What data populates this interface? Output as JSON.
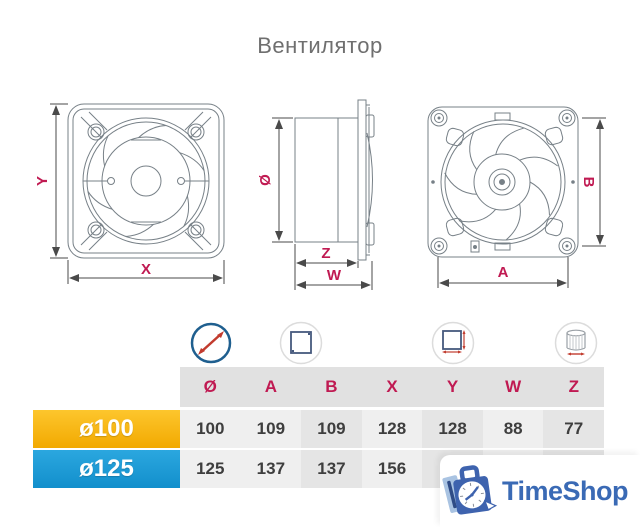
{
  "title": "Вентилятор",
  "diagrams": {
    "front_view": {
      "vertical_label": "Y",
      "horizontal_label": "X"
    },
    "side_view": {
      "diameter_label": "Ø",
      "inner_depth_label": "Z",
      "outer_depth_label": "W"
    },
    "back_view": {
      "vertical_label": "B",
      "horizontal_label": "A"
    }
  },
  "spec_table": {
    "icons": [
      "diameter-icon",
      "panel-size-icon",
      "mounting-size-icon",
      "duct-depth-icon"
    ],
    "columns": [
      "Ø",
      "A",
      "B",
      "X",
      "Y",
      "W",
      "Z"
    ],
    "rows": [
      {
        "label": "ø100",
        "color": "#f7b500",
        "values": [
          "100",
          "109",
          "109",
          "128",
          "128",
          "88",
          "77"
        ]
      },
      {
        "label": "ø125",
        "color": "#1e9cd7",
        "values": [
          "125",
          "137",
          "137",
          "156",
          "",
          "",
          ""
        ]
      }
    ]
  },
  "watermark": {
    "brand": "TimeShop",
    "color": "#3a6ab5"
  },
  "colors": {
    "accent_red": "#c01a52",
    "dimension_line": "#4a4a4a",
    "drawing_stroke": "#778087",
    "header_bg": "#e1e1e1",
    "cell_light": "#efefef",
    "cell_dark": "#e5e5e5"
  }
}
